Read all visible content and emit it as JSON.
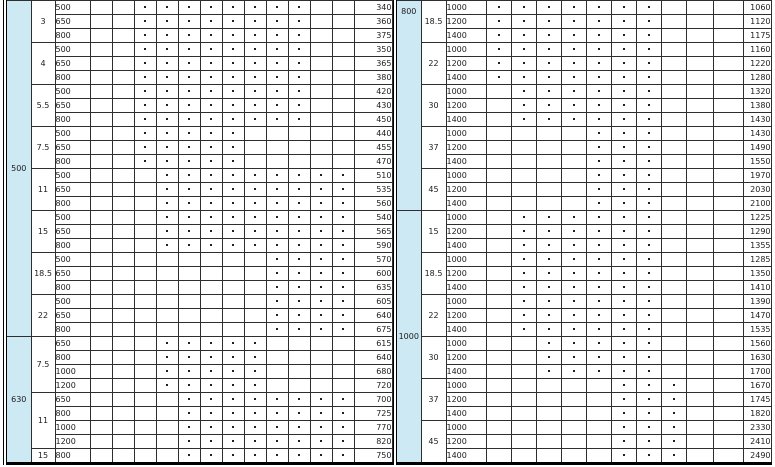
{
  "page": {
    "background": "#ffffff"
  },
  "colors": {
    "group_column_bg": "#cde9f3",
    "grid_line": "#2e2e2e",
    "text": "#1c1c1c",
    "outer_border": "#000000"
  },
  "tables": [
    {
      "name": "spec-table-left",
      "narrow_columns": 12,
      "groups": [
        {
          "label": "500",
          "cut_top": false,
          "powers": [
            {
              "label": "3",
              "dots": [
                3,
                4,
                5,
                6,
                7,
                8,
                9,
                10
              ],
              "rows": [
                {
                  "speed": "500",
                  "value": "340"
                },
                {
                  "speed": "650",
                  "value": "360"
                },
                {
                  "speed": "800",
                  "value": "375"
                }
              ]
            },
            {
              "label": "4",
              "dots": [
                3,
                4,
                5,
                6,
                7,
                8,
                9,
                10
              ],
              "rows": [
                {
                  "speed": "500",
                  "value": "350"
                },
                {
                  "speed": "650",
                  "value": "365"
                },
                {
                  "speed": "800",
                  "value": "380"
                }
              ]
            },
            {
              "label": "5.5",
              "dots": [
                3,
                4,
                5,
                6,
                7,
                8,
                9,
                10
              ],
              "rows": [
                {
                  "speed": "500",
                  "value": "420"
                },
                {
                  "speed": "650",
                  "value": "430"
                },
                {
                  "speed": "800",
                  "value": "450"
                }
              ]
            },
            {
              "label": "7.5",
              "dots": [
                3,
                4,
                5,
                6,
                7
              ],
              "rows": [
                {
                  "speed": "500",
                  "value": "440"
                },
                {
                  "speed": "650",
                  "value": "455"
                },
                {
                  "speed": "800",
                  "value": "470"
                }
              ]
            },
            {
              "label": "11",
              "dots": [
                4,
                5,
                6,
                7,
                8,
                9,
                10,
                11,
                12
              ],
              "rows": [
                {
                  "speed": "500",
                  "value": "510"
                },
                {
                  "speed": "650",
                  "value": "535"
                },
                {
                  "speed": "800",
                  "value": "560"
                }
              ]
            },
            {
              "label": "15",
              "dots": [
                4,
                5,
                6,
                7,
                8,
                9,
                10,
                11,
                12
              ],
              "rows": [
                {
                  "speed": "500",
                  "value": "540"
                },
                {
                  "speed": "650",
                  "value": "565"
                },
                {
                  "speed": "800",
                  "value": "590"
                }
              ]
            },
            {
              "label": "18.5",
              "dots": [
                9,
                10,
                11,
                12
              ],
              "rows": [
                {
                  "speed": "500",
                  "value": "570"
                },
                {
                  "speed": "650",
                  "value": "600"
                },
                {
                  "speed": "800",
                  "value": "635"
                }
              ]
            },
            {
              "label": "22",
              "dots": [
                9,
                10,
                11,
                12
              ],
              "rows": [
                {
                  "speed": "500",
                  "value": "605"
                },
                {
                  "speed": "650",
                  "value": "640"
                },
                {
                  "speed": "800",
                  "value": "675"
                }
              ]
            }
          ]
        },
        {
          "label": "630",
          "cut_top": false,
          "powers": [
            {
              "label": "7.5",
              "dots": [
                4,
                5,
                6,
                7,
                8
              ],
              "rows": [
                {
                  "speed": "650",
                  "value": "615"
                },
                {
                  "speed": "800",
                  "value": "640"
                },
                {
                  "speed": "1000",
                  "value": "680"
                },
                {
                  "speed": "1200",
                  "value": "720"
                }
              ]
            },
            {
              "label": "11",
              "dots": [
                5,
                6,
                7,
                8,
                9,
                10,
                11,
                12
              ],
              "rows": [
                {
                  "speed": "650",
                  "value": "700"
                },
                {
                  "speed": "800",
                  "value": "725"
                },
                {
                  "speed": "1000",
                  "value": "770"
                },
                {
                  "speed": "1200",
                  "value": "820"
                }
              ]
            },
            {
              "label": "15",
              "dots": [
                5,
                6,
                7,
                8,
                9,
                10,
                11,
                12
              ],
              "rows": [
                {
                  "speed": "800",
                  "value": "750"
                }
              ]
            }
          ]
        }
      ]
    },
    {
      "name": "spec-table-right",
      "narrow_columns": 10,
      "groups": [
        {
          "label": "800",
          "cut_top": true,
          "powers": [
            {
              "label": "18.5",
              "dots": [
                1,
                2,
                3,
                4,
                5,
                6,
                7
              ],
              "rows": [
                {
                  "speed": "1000",
                  "value": "1060"
                },
                {
                  "speed": "1200",
                  "value": "1120"
                },
                {
                  "speed": "1400",
                  "value": "1175"
                }
              ]
            },
            {
              "label": "22",
              "dots": [
                1,
                2,
                3,
                4,
                5,
                6,
                7
              ],
              "rows": [
                {
                  "speed": "1000",
                  "value": "1160"
                },
                {
                  "speed": "1200",
                  "value": "1220"
                },
                {
                  "speed": "1400",
                  "value": "1280"
                }
              ]
            },
            {
              "label": "30",
              "dots": [
                2,
                3,
                4,
                5,
                6,
                7
              ],
              "rows": [
                {
                  "speed": "1000",
                  "value": "1320"
                },
                {
                  "speed": "1200",
                  "value": "1380"
                },
                {
                  "speed": "1400",
                  "value": "1430"
                }
              ]
            },
            {
              "label": "37",
              "dots": [
                5,
                6,
                7
              ],
              "rows": [
                {
                  "speed": "1000",
                  "value": "1430"
                },
                {
                  "speed": "1200",
                  "value": "1490"
                },
                {
                  "speed": "1400",
                  "value": "1550"
                }
              ]
            },
            {
              "label": "45",
              "dots": [
                5,
                6,
                7
              ],
              "rows": [
                {
                  "speed": "1000",
                  "value": "1970"
                },
                {
                  "speed": "1200",
                  "value": "2030"
                },
                {
                  "speed": "1400",
                  "value": "2100"
                }
              ]
            }
          ]
        },
        {
          "label": "1000",
          "cut_top": false,
          "powers": [
            {
              "label": "15",
              "dots": [
                2,
                3,
                4,
                5,
                6,
                7
              ],
              "rows": [
                {
                  "speed": "1000",
                  "value": "1225"
                },
                {
                  "speed": "1200",
                  "value": "1290"
                },
                {
                  "speed": "1400",
                  "value": "1355"
                }
              ]
            },
            {
              "label": "18.5",
              "dots": [
                2,
                3,
                4,
                5,
                6,
                7
              ],
              "rows": [
                {
                  "speed": "1000",
                  "value": "1285"
                },
                {
                  "speed": "1200",
                  "value": "1350"
                },
                {
                  "speed": "1400",
                  "value": "1410"
                }
              ]
            },
            {
              "label": "22",
              "dots": [
                2,
                3,
                4,
                5,
                6,
                7
              ],
              "rows": [
                {
                  "speed": "1000",
                  "value": "1390"
                },
                {
                  "speed": "1200",
                  "value": "1470"
                },
                {
                  "speed": "1400",
                  "value": "1535"
                }
              ]
            },
            {
              "label": "30",
              "dots": [
                3,
                4,
                5,
                6,
                7
              ],
              "rows": [
                {
                  "speed": "1000",
                  "value": "1560"
                },
                {
                  "speed": "1200",
                  "value": "1630"
                },
                {
                  "speed": "1400",
                  "value": "1700"
                }
              ]
            },
            {
              "label": "37",
              "dots": [
                6,
                7,
                8
              ],
              "rows": [
                {
                  "speed": "1000",
                  "value": "1670"
                },
                {
                  "speed": "1200",
                  "value": "1745"
                },
                {
                  "speed": "1400",
                  "value": "1820"
                }
              ]
            },
            {
              "label": "45",
              "dots": [
                6,
                7,
                8
              ],
              "rows": [
                {
                  "speed": "1000",
                  "value": "2330"
                },
                {
                  "speed": "1200",
                  "value": "2410"
                },
                {
                  "speed": "1400",
                  "value": "2490"
                }
              ]
            }
          ]
        }
      ]
    }
  ]
}
